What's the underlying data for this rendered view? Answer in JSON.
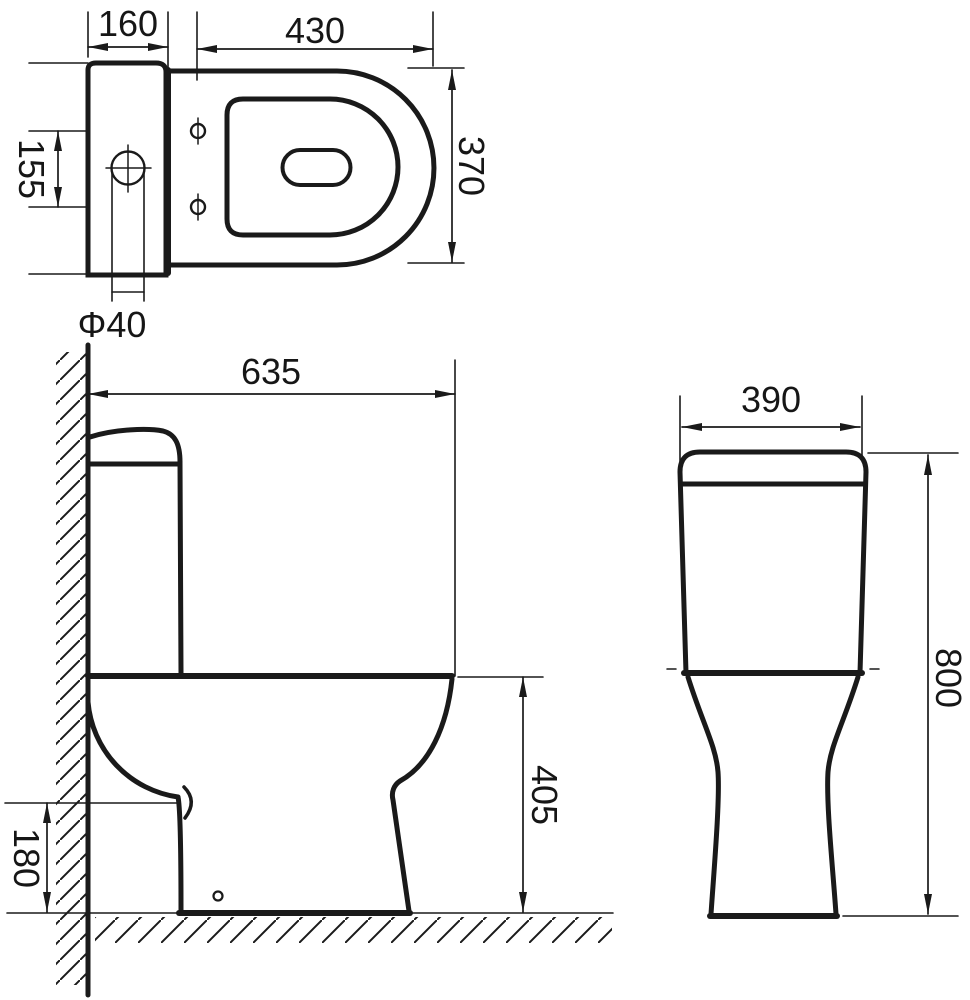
{
  "drawing": {
    "type": "technical-dimension-drawing",
    "subject": "close-coupled toilet, three orthographic views with millimetre dimensions",
    "line_color": "#1a1a1a",
    "background": "#ffffff",
    "views": {
      "top": {
        "label": "top view",
        "dims": {
          "tank_depth": "160",
          "seat_length": "430",
          "bowl_width": "370",
          "hole_spacing": "155",
          "inlet_diameter": "Φ40"
        }
      },
      "side": {
        "label": "side view",
        "dims": {
          "overall_depth": "635",
          "seat_height": "405",
          "outlet_height": "180"
        }
      },
      "front": {
        "label": "front view",
        "dims": {
          "tank_width": "390",
          "overall_height": "800"
        }
      }
    }
  }
}
